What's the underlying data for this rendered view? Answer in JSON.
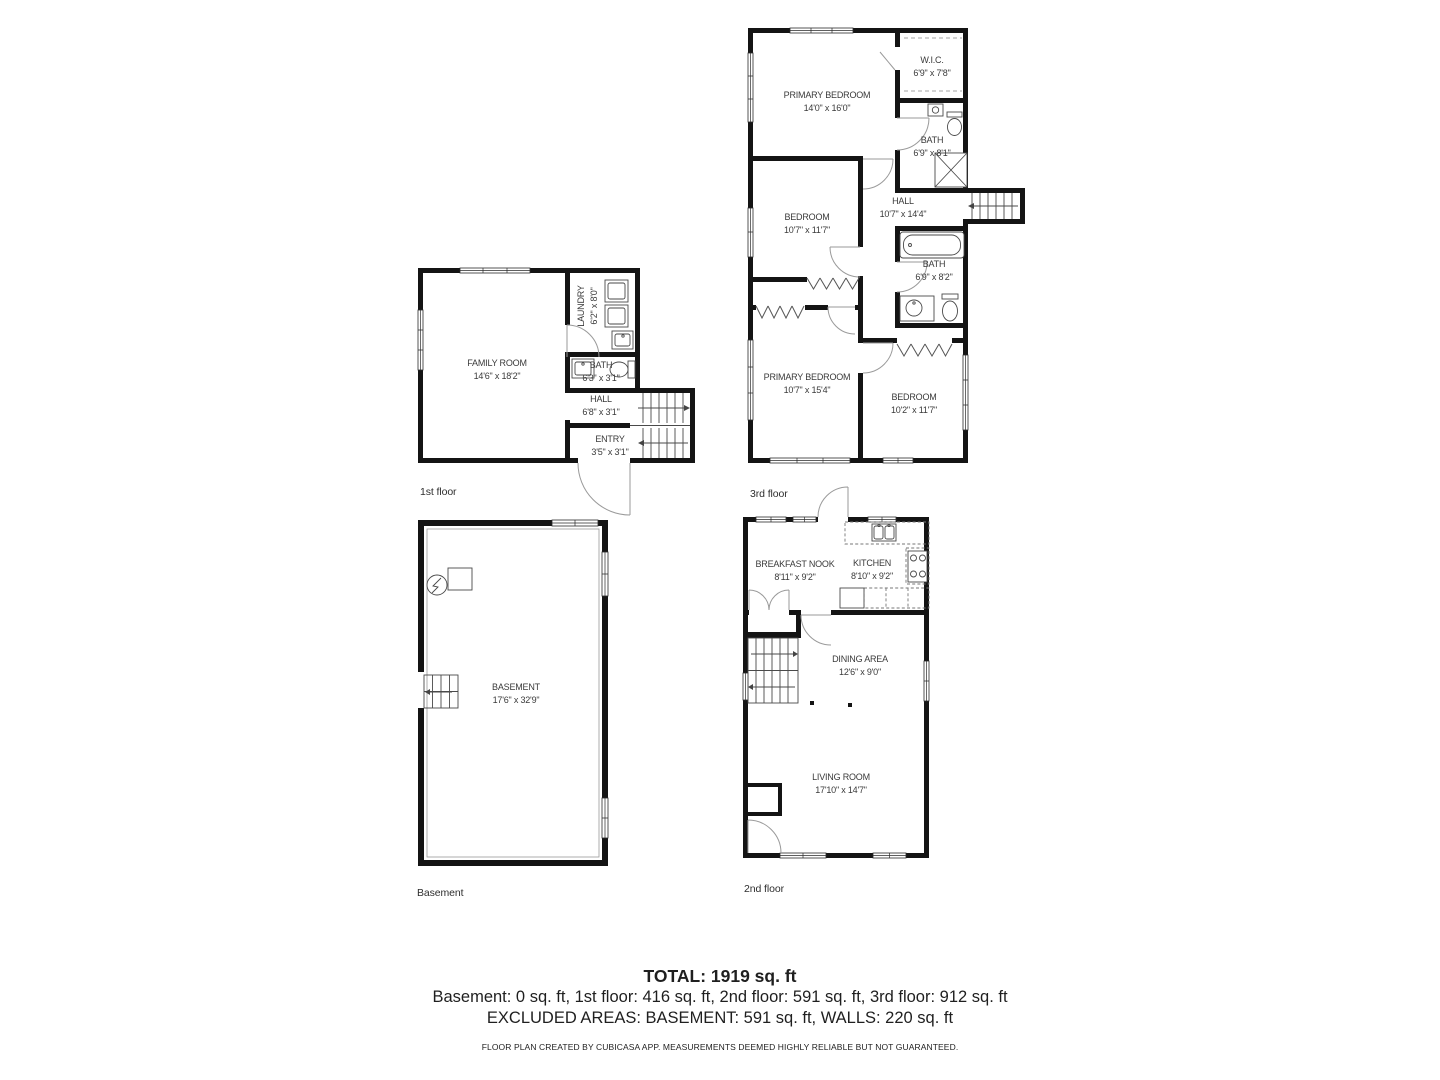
{
  "floors": {
    "first": {
      "label": "1st floor",
      "rooms": {
        "family_room": {
          "name": "FAMILY ROOM",
          "dims": "14'6\" x 18'2\""
        },
        "laundry": {
          "name": "LAUNDRY",
          "dims": "6'2\" x 8'0\""
        },
        "bath": {
          "name": "BATH",
          "dims": "6'3\" x 3'1\""
        },
        "hall": {
          "name": "HALL",
          "dims": "6'8\" x 3'1\""
        },
        "entry": {
          "name": "ENTRY",
          "dims": "3'5\" x 3'1\""
        }
      }
    },
    "second": {
      "label": "2nd floor",
      "rooms": {
        "breakfast_nook": {
          "name": "BREAKFAST NOOK",
          "dims": "8'11\" x 9'2\""
        },
        "kitchen": {
          "name": "KITCHEN",
          "dims": "8'10\" x 9'2\""
        },
        "dining_area": {
          "name": "DINING AREA",
          "dims": "12'6\" x 9'0\""
        },
        "living_room": {
          "name": "LIVING ROOM",
          "dims": "17'10\" x 14'7\""
        }
      }
    },
    "third": {
      "label": "3rd floor",
      "rooms": {
        "primary_bedroom_upper": {
          "name": "PRIMARY BEDROOM",
          "dims": "14'0\" x 16'0\""
        },
        "wic": {
          "name": "W.I.C.",
          "dims": "6'9\" x 7'8\""
        },
        "bath_upper": {
          "name": "BATH",
          "dims": "6'9\" x 8'1\""
        },
        "bedroom_upper": {
          "name": "BEDROOM",
          "dims": "10'7\" x 11'7\""
        },
        "hall": {
          "name": "HALL",
          "dims": "10'7\" x 14'4\""
        },
        "bath_lower": {
          "name": "BATH",
          "dims": "6'9\" x 8'2\""
        },
        "primary_bedroom_lower": {
          "name": "PRIMARY BEDROOM",
          "dims": "10'7\" x 15'4\""
        },
        "bedroom_lower": {
          "name": "BEDROOM",
          "dims": "10'2\" x 11'7\""
        }
      }
    },
    "basement": {
      "label": "Basement",
      "rooms": {
        "basement": {
          "name": "BASEMENT",
          "dims": "17'6\" x 32'9\""
        }
      }
    }
  },
  "summary": {
    "total": "TOTAL: 1919 sq. ft",
    "breakdown": "Basement: 0 sq. ft, 1st floor: 416 sq. ft, 2nd floor: 591 sq. ft, 3rd floor: 912 sq. ft",
    "excluded": "EXCLUDED AREAS: BASEMENT: 591 sq. ft, WALLS: 220 sq. ft",
    "disclaimer": "FLOOR PLAN CREATED BY CUBICASA APP. MEASUREMENTS DEEMED HIGHLY RELIABLE BUT NOT GUARANTEED."
  }
}
